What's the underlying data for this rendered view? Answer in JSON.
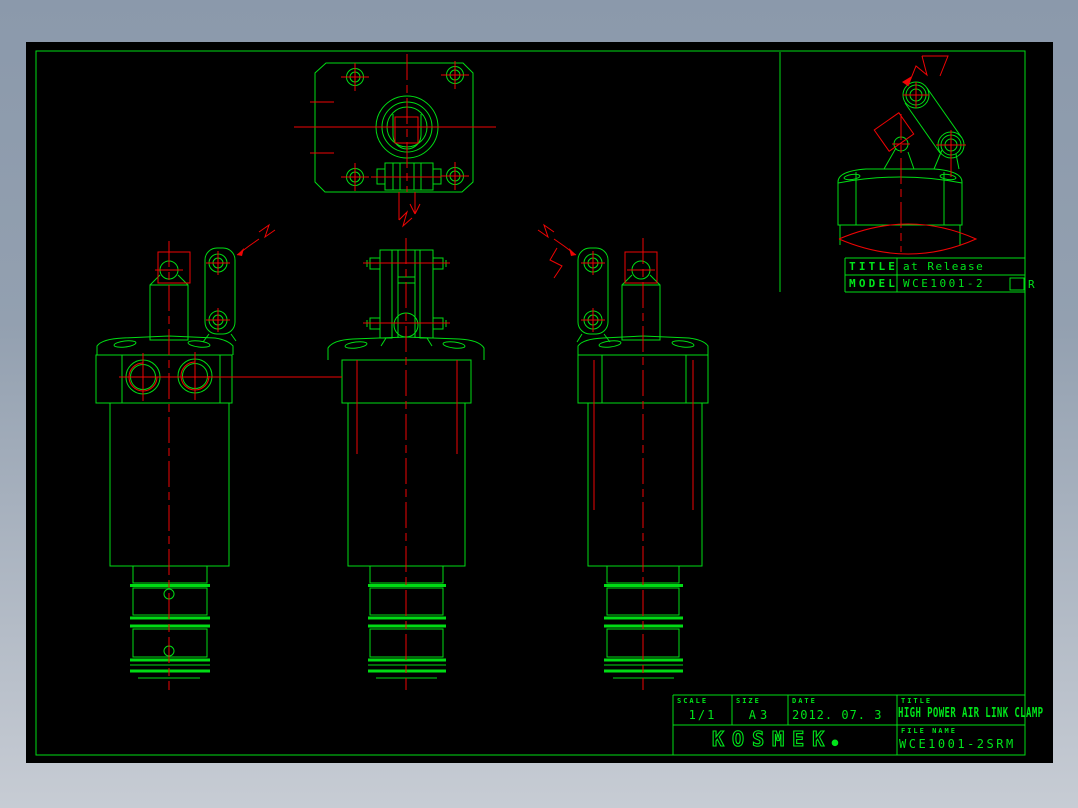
{
  "window": {
    "surround_top_color": "#8b99ab",
    "surround_bottom_color": "#c7ccd4",
    "canvas_color": "#000000"
  },
  "drawing": {
    "line_color": "#00dc14",
    "centerline_color": "#ee0404",
    "views": [
      "top-view",
      "left-side-view",
      "front-view",
      "right-side-view",
      "release-detail-view"
    ]
  },
  "detail_panel": {
    "title_label": "TITLE",
    "title_value": "at Release",
    "model_label": "MODEL",
    "model_value": "WCE1001-2",
    "model_option_box": "□",
    "model_suffix": "R"
  },
  "title_block": {
    "scale_label": "SCALE",
    "scale_value": "1/1",
    "size_label": "SIZE",
    "size_value": "A3",
    "date_label": "DATE",
    "date_value": "2012. 07. 3",
    "title_label": "TITLE",
    "title_value": "HIGH POWER AIR LINK CLAMP",
    "file_label": "FILE NAME",
    "file_value": "WCE1001-2SRM",
    "company": "KOSMEK",
    "company_reg_mark": "®"
  }
}
